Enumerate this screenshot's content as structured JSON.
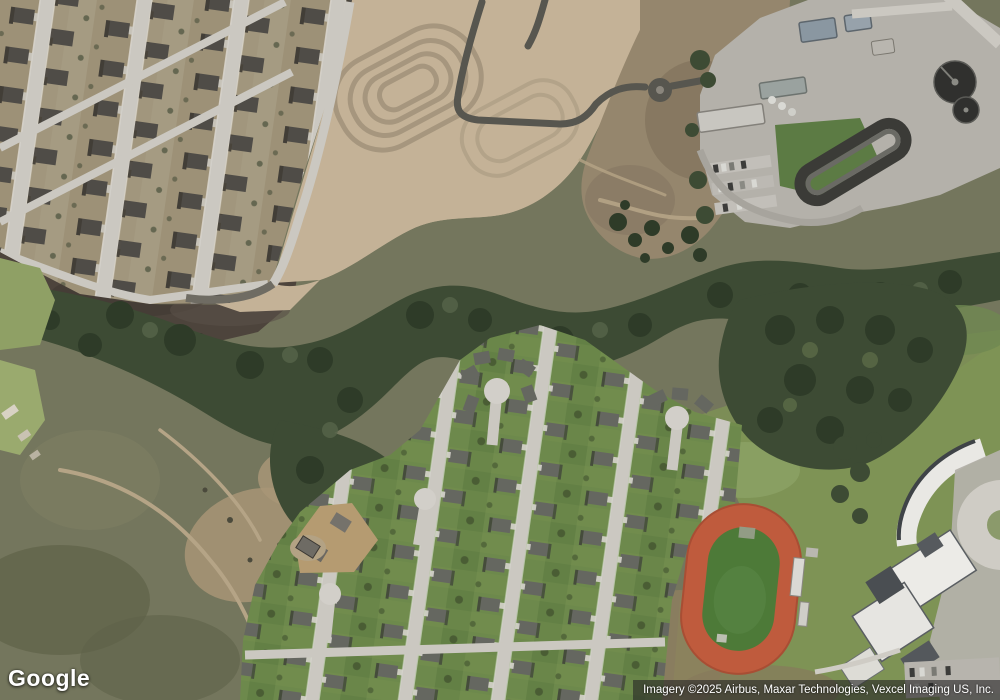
{
  "branding": {
    "logo_text": "Google"
  },
  "attribution": {
    "text": "Imagery ©2025 Airbus, Maxar Technologies, Vexcel Imaging US, Inc."
  },
  "palette": {
    "scrub": "#74765d",
    "scrub_dark": "#5f6349",
    "dirt": "#c4b297",
    "dirt_dark": "#95866d",
    "field_dark": "#4d443c",
    "trees": "#3d4b34",
    "trees_dark": "#2e3b28",
    "grass": "#7e9355",
    "lawn": "#6d894c",
    "yard": "#a1967d",
    "road_light": "#cbc8c1",
    "road_dark": "#57564f",
    "roof_nw": "#4f4c47",
    "roof_s": "#656760",
    "concrete": "#b4b1aa",
    "white_roof": "#eceae5",
    "track": "#bf5b3d",
    "track_field": "#4d7a38",
    "attribution_bg": "rgba(38,38,38,0.62)",
    "text_white": "#ffffff"
  }
}
